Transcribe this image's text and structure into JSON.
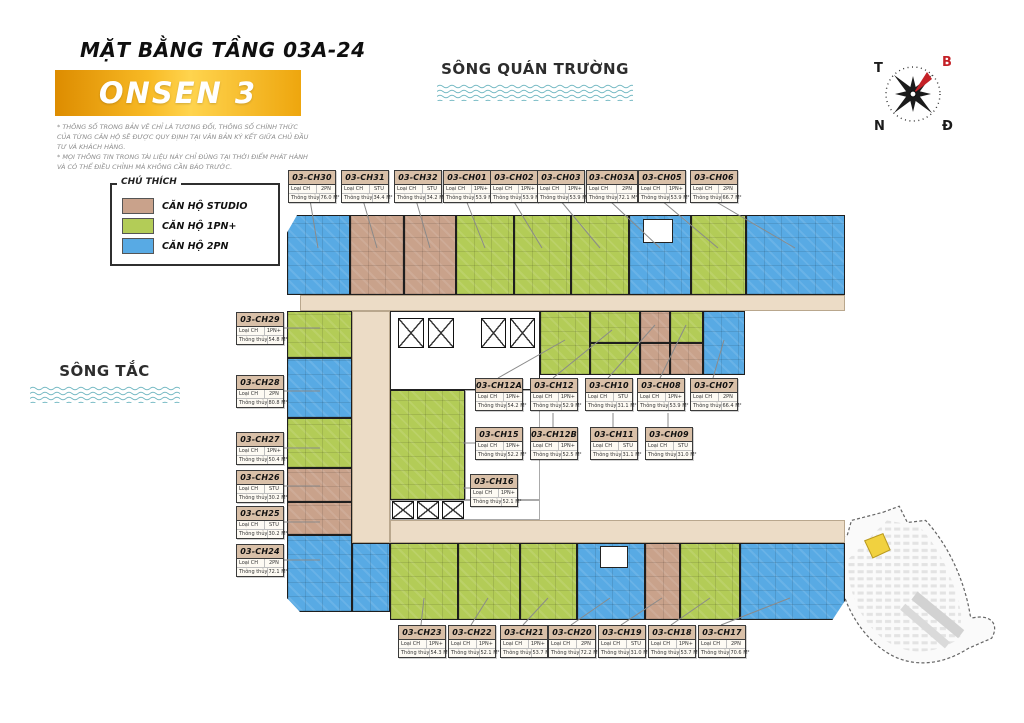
{
  "header": {
    "title": "MẶT BẰNG TẦNG 03A-24",
    "banner": "ONSEN 3",
    "disclaimer_line1": "* THÔNG SỐ TRONG BẢN VẼ CHỈ LÀ TƯƠNG ĐỐI, THÔNG SỐ CHÍNH THỨC CỦA TỪNG CĂN HỘ SẼ ĐƯỢC QUY ĐỊNH TẠI VĂN BẢN KÝ KẾT GIỮA CHỦ ĐẦU TƯ VÀ KHÁCH HÀNG.",
    "disclaimer_line2": "* MỌI THÔNG TIN TRONG TÀI LIỆU NÀY CHỈ ĐÚNG TẠI THỜI ĐIỂM PHÁT HÀNH VÀ CÓ THỂ ĐIỀU CHỈNH MÀ KHÔNG CẦN BÁO TRƯỚC."
  },
  "legend": {
    "title": "CHÚ THÍCH",
    "items": [
      {
        "label": "CĂN HỘ STUDIO",
        "type": "STU",
        "color": "#c9a28b"
      },
      {
        "label": "CĂN HỘ 1PN+",
        "type": "1PN+",
        "color": "#b3cc57"
      },
      {
        "label": "CĂN HỘ 2PN",
        "type": "2PN",
        "color": "#58aae4"
      }
    ]
  },
  "rivers": {
    "top": "SÔNG QUÁN TRƯỜNG",
    "left": "SÔNG TẮC"
  },
  "compass": {
    "west": "T",
    "north": "B",
    "south": "N",
    "east": "Đ"
  },
  "tag_fields": {
    "type_label": "Loại CH",
    "area_label": "Thông thủy"
  },
  "units": [
    {
      "id": "03-CH30",
      "group": "top",
      "type": "2PN",
      "area": "76.0 M²"
    },
    {
      "id": "03-CH31",
      "group": "top",
      "type": "STU",
      "area": "34.4 M²"
    },
    {
      "id": "03-CH32",
      "group": "top",
      "type": "STU",
      "area": "34.2 M²"
    },
    {
      "id": "03-CH01",
      "group": "top",
      "type": "1PN+",
      "area": "53.9 M²"
    },
    {
      "id": "03-CH02",
      "group": "top",
      "type": "1PN+",
      "area": "53.9 M²"
    },
    {
      "id": "03-CH03",
      "group": "top",
      "type": "1PN+",
      "area": "53.9 M²"
    },
    {
      "id": "03-CH03A",
      "group": "top",
      "type": "2PN",
      "area": "72.1 M²"
    },
    {
      "id": "03-CH05",
      "group": "top",
      "type": "1PN+",
      "area": "53.9 M²"
    },
    {
      "id": "03-CH06",
      "group": "top",
      "type": "2PN",
      "area": "66.7 M²"
    },
    {
      "id": "03-CH29",
      "group": "left",
      "type": "1PN+",
      "area": "54.8 M²"
    },
    {
      "id": "03-CH28",
      "group": "left",
      "type": "2PN",
      "area": "80.8 M²"
    },
    {
      "id": "03-CH27",
      "group": "left",
      "type": "1PN+",
      "area": "50.4 M²"
    },
    {
      "id": "03-CH26",
      "group": "left",
      "type": "STU",
      "area": "30.2 M²"
    },
    {
      "id": "03-CH25",
      "group": "left",
      "type": "STU",
      "area": "30.2 M²"
    },
    {
      "id": "03-CH24",
      "group": "left",
      "type": "2PN",
      "area": "72.1 M²"
    },
    {
      "id": "03-CH12A",
      "group": "mid-row-1",
      "type": "1PN+",
      "area": "54.2 M²"
    },
    {
      "id": "03-CH12",
      "group": "mid-row-1",
      "type": "1PN+",
      "area": "52.9 M²"
    },
    {
      "id": "03-CH10",
      "group": "mid-row-1",
      "type": "STU",
      "area": "31.1 M²"
    },
    {
      "id": "03-CH08",
      "group": "mid-row-1",
      "type": "1PN+",
      "area": "53.9 M²"
    },
    {
      "id": "03-CH07",
      "group": "mid-row-1",
      "type": "2PN",
      "area": "66.4 M²"
    },
    {
      "id": "03-CH15",
      "group": "mid-row-2",
      "type": "1PN+",
      "area": "52.2 M²"
    },
    {
      "id": "03-CH12B",
      "group": "mid-row-2",
      "type": "1PN+",
      "area": "52.5 M²"
    },
    {
      "id": "03-CH11",
      "group": "mid-row-2",
      "type": "STU",
      "area": "31.1 M²"
    },
    {
      "id": "03-CH09",
      "group": "mid-row-2",
      "type": "STU",
      "area": "31.0 M²"
    },
    {
      "id": "03-CH16",
      "group": "mid-single",
      "type": "1PN+",
      "area": "52.1 M²"
    },
    {
      "id": "03-CH23",
      "group": "bottom",
      "type": "1PN+",
      "area": "54.3 M²"
    },
    {
      "id": "03-CH22",
      "group": "bottom",
      "type": "1PN+",
      "area": "52.1 M²"
    },
    {
      "id": "03-CH21",
      "group": "bottom",
      "type": "1PN+",
      "area": "53.7 M²"
    },
    {
      "id": "03-CH20",
      "group": "bottom",
      "type": "2PN",
      "area": "72.2 M²"
    },
    {
      "id": "03-CH19",
      "group": "bottom",
      "type": "STU",
      "area": "31.0 M²"
    },
    {
      "id": "03-CH18",
      "group": "bottom",
      "type": "1PN+",
      "area": "53.7 M²"
    },
    {
      "id": "03-CH17",
      "group": "bottom",
      "type": "2PN",
      "area": "70.6 M²"
    }
  ]
}
